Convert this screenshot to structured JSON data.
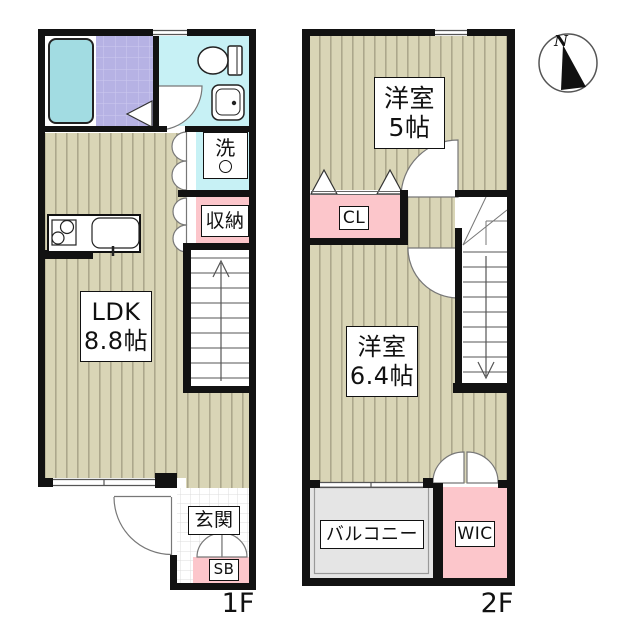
{
  "floorplan": {
    "floor1": {
      "label": "1F",
      "rooms": {
        "ldk_line1": "LDK",
        "ldk_line2": "8.8帖",
        "storage": "収納",
        "laundry": "洗",
        "entrance": "玄関",
        "shoebox": "SB"
      }
    },
    "floor2": {
      "label": "2F",
      "rooms": {
        "bedroom5_line1": "洋室",
        "bedroom5_line2": "5帖",
        "bedroom64_line1": "洋室",
        "bedroom64_line2": "6.4帖",
        "closet": "CL",
        "walkin_closet": "WIC",
        "balcony": "バルコニー"
      }
    },
    "compass": {
      "north": "N"
    },
    "colors": {
      "wall": "#121212",
      "floor": "#d9d5b6",
      "floor_stripe": "#aca78c",
      "pink": "#fcc6cb",
      "cyan": "#c7f1f5",
      "bathtub": "#a2dce2",
      "bath_tile": "#b6b2e4",
      "balcony_gray": "#e5e5e5"
    }
  }
}
